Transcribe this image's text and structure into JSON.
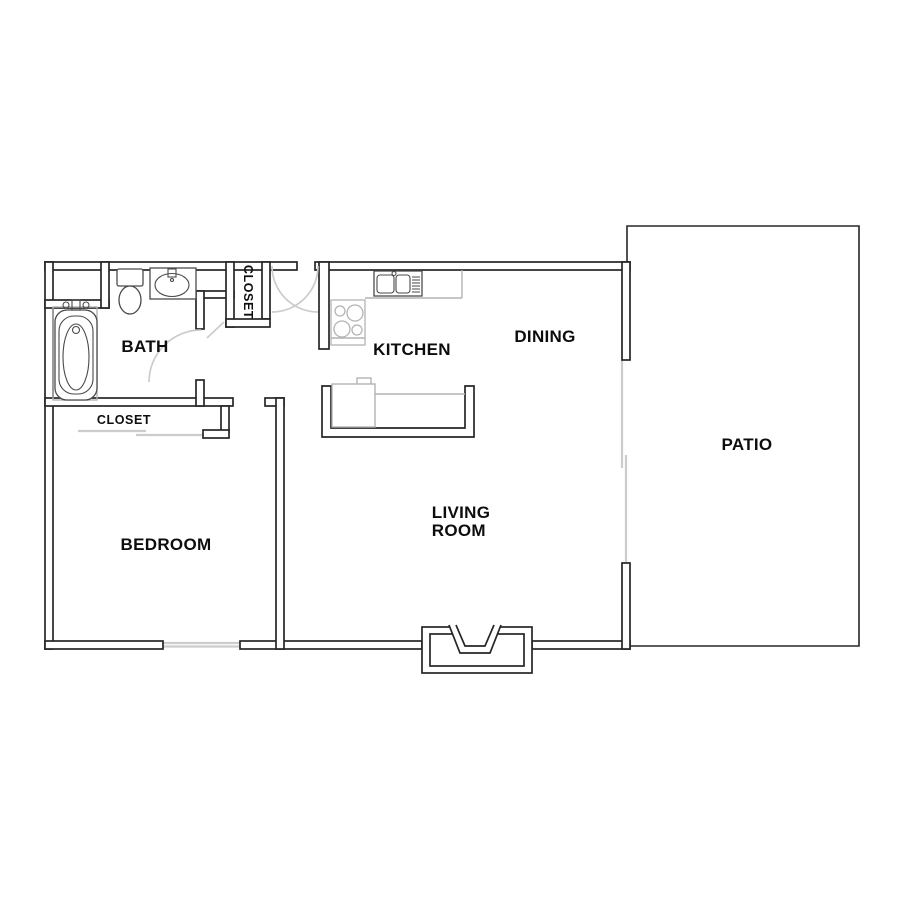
{
  "document": {
    "type": "apartment-floor-plan"
  },
  "rooms": {
    "bath": {
      "label": "BATH"
    },
    "hall_closet": {
      "label": "CLOSET"
    },
    "kitchen": {
      "label": "KITCHEN"
    },
    "dining": {
      "label": "DINING"
    },
    "patio": {
      "label": "PATIO"
    },
    "bedroom": {
      "label": "BEDROOM"
    },
    "bedroom_closet": {
      "label": "CLOSET"
    },
    "living_room": {
      "label": "LIVING\nROOM"
    }
  },
  "fixtures": [
    "bathtub-icon",
    "toilet-icon",
    "vanity-sink-icon",
    "stove-icon",
    "double-sink-icon",
    "breakfast-bar",
    "entry-alcove",
    "door-swing-arc",
    "sliding-door",
    "window"
  ],
  "colors": {
    "wall": "#262626",
    "fixture": "#4a4a4a",
    "counter": "#b3b3b3",
    "light_gray": "#cccccc",
    "text": "#0d0d0d",
    "background": "#ffffff"
  }
}
